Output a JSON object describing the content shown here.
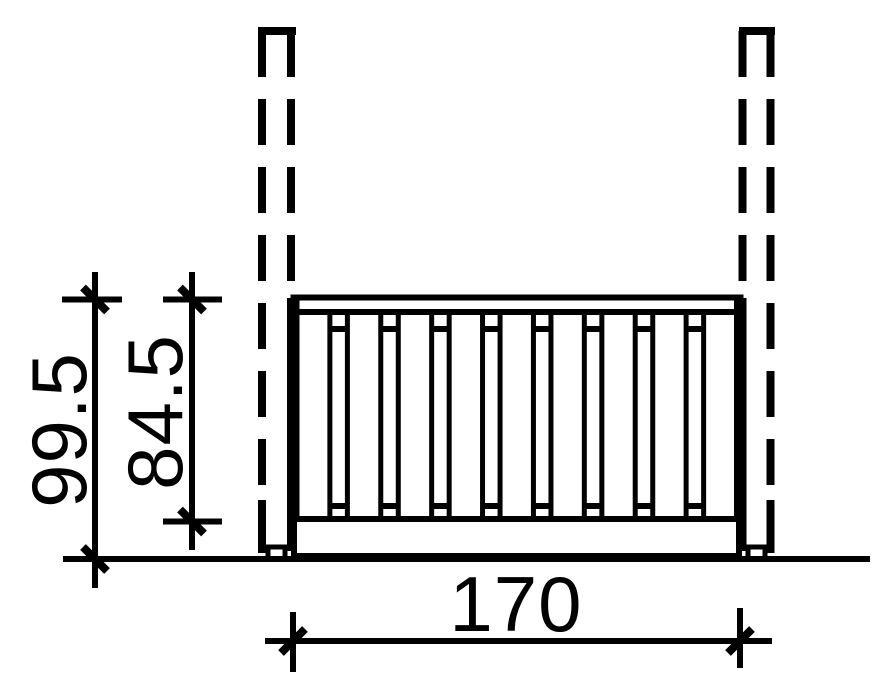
{
  "drawing": {
    "description": "Technical dimension drawing of a railing section mounted between two dashed posts on a ground line",
    "dimensions": {
      "total_height": "99.5",
      "railing_height": "84.5",
      "railing_width": "170"
    },
    "colors": {
      "line": "#000000",
      "background": "#ffffff"
    }
  }
}
